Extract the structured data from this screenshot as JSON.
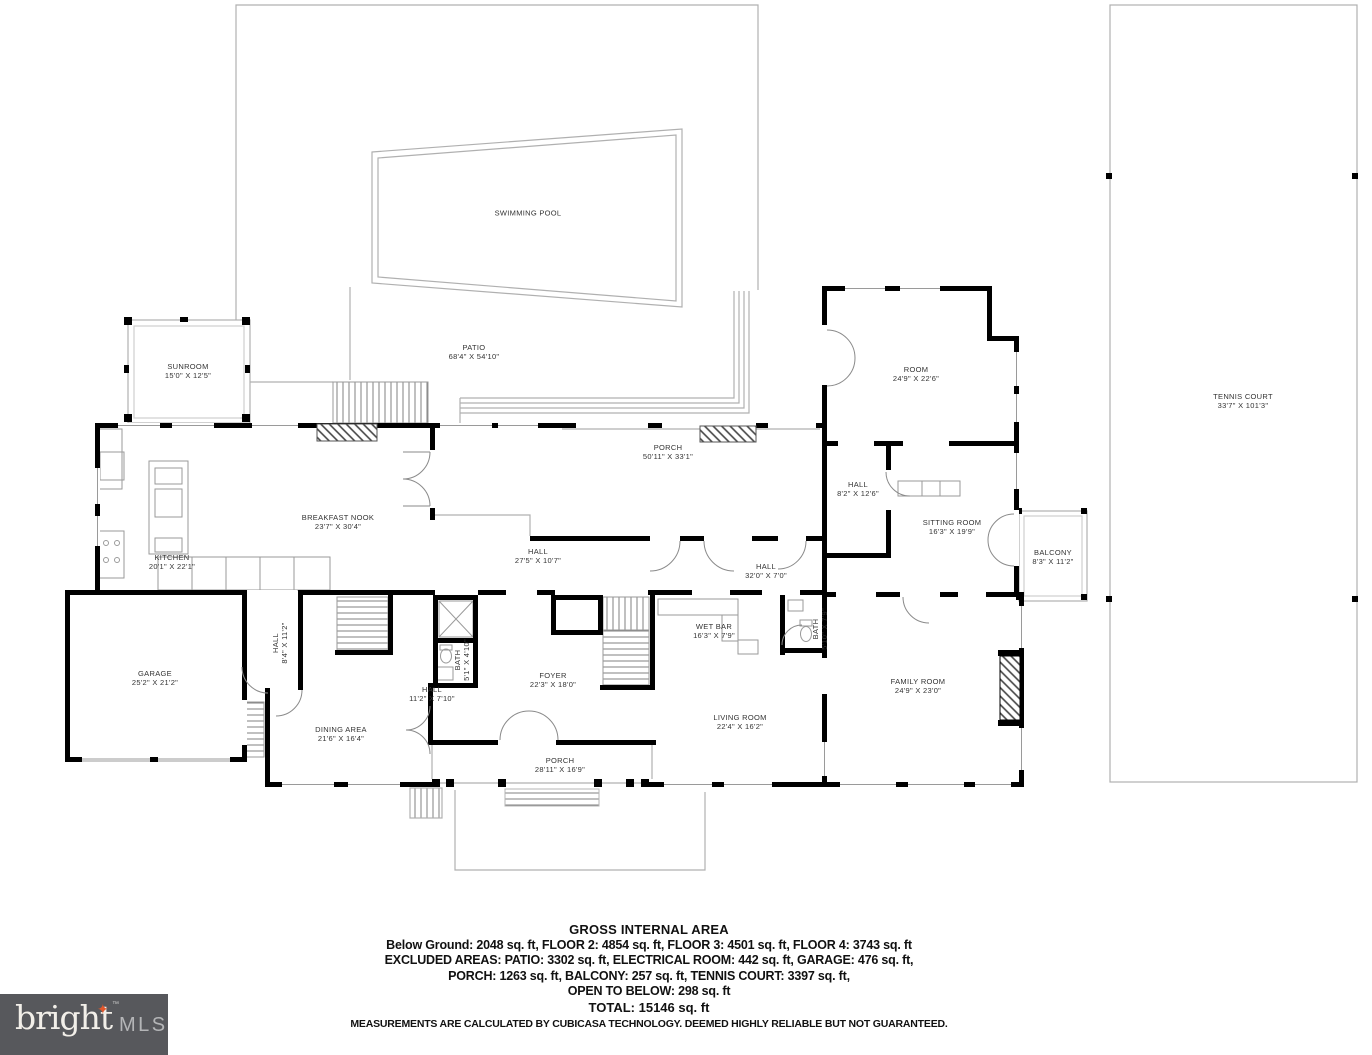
{
  "plan": {
    "rooms": [
      {
        "id": "swimming-pool",
        "name": "SWIMMING POOL",
        "dims": "",
        "x": 528,
        "y": 213
      },
      {
        "id": "patio",
        "name": "PATIO",
        "dims": "68'4\" X 54'10\"",
        "x": 474,
        "y": 352
      },
      {
        "id": "sunroom",
        "name": "SUNROOM",
        "dims": "15'0\" X 12'5\"",
        "x": 188,
        "y": 371
      },
      {
        "id": "tennis-court",
        "name": "TENNIS COURT",
        "dims": "33'7\" X 101'3\"",
        "x": 1243,
        "y": 401
      },
      {
        "id": "room",
        "name": "ROOM",
        "dims": "24'9\" X 22'6\"",
        "x": 916,
        "y": 374
      },
      {
        "id": "porch-rear",
        "name": "PORCH",
        "dims": "50'11\" X 33'1\"",
        "x": 668,
        "y": 452
      },
      {
        "id": "hall-upper",
        "name": "HALL",
        "dims": "8'2\" X 12'6\"",
        "x": 858,
        "y": 489
      },
      {
        "id": "sitting-room",
        "name": "SITTING ROOM",
        "dims": "16'3\" X 19'9\"",
        "x": 952,
        "y": 527
      },
      {
        "id": "balcony",
        "name": "BALCONY",
        "dims": "8'3\" X 11'2\"",
        "x": 1053,
        "y": 557
      },
      {
        "id": "breakfast-nook",
        "name": "BREAKFAST NOOK",
        "dims": "23'7\" X 30'4\"",
        "x": 338,
        "y": 522
      },
      {
        "id": "kitchen",
        "name": "KITCHEN",
        "dims": "20'1\" X 22'1\"",
        "x": 172,
        "y": 562
      },
      {
        "id": "hall-west",
        "name": "HALL",
        "dims": "27'5\" X 10'7\"",
        "x": 538,
        "y": 556
      },
      {
        "id": "hall-center",
        "name": "HALL",
        "dims": "32'0\" X 7'0\"",
        "x": 766,
        "y": 571
      },
      {
        "id": "garage",
        "name": "GARAGE",
        "dims": "25'2\" X 21'2\"",
        "x": 155,
        "y": 678
      },
      {
        "id": "hall-stairs",
        "name": "HALL",
        "dims": "8'4\" X 11'2\"",
        "x": 280,
        "y": 643,
        "rot": true
      },
      {
        "id": "bath-foyer",
        "name": "BATH",
        "dims": "5'1\" X 4'10\"",
        "x": 462,
        "y": 660,
        "rot": true
      },
      {
        "id": "hall-south",
        "name": "HALL",
        "dims": "11'2\" X 7'10\"",
        "x": 432,
        "y": 694
      },
      {
        "id": "dining-area",
        "name": "DINING AREA",
        "dims": "21'6\" X 16'4\"",
        "x": 341,
        "y": 734
      },
      {
        "id": "foyer",
        "name": "FOYER",
        "dims": "22'3\" X 18'0\"",
        "x": 553,
        "y": 680
      },
      {
        "id": "wet-bar",
        "name": "WET BAR",
        "dims": "16'3\" X 7'9\"",
        "x": 714,
        "y": 631
      },
      {
        "id": "bath-wetbar",
        "name": "BATH",
        "dims": "5'10\" X 7'9\"",
        "x": 820,
        "y": 629,
        "rot": true
      },
      {
        "id": "living-room",
        "name": "LIVING ROOM",
        "dims": "22'4\" X 16'2\"",
        "x": 740,
        "y": 722
      },
      {
        "id": "family-room",
        "name": "FAMILY ROOM",
        "dims": "24'9\" X 23'0\"",
        "x": 918,
        "y": 686
      },
      {
        "id": "porch-front",
        "name": "PORCH",
        "dims": "28'11\" X 16'9\"",
        "x": 560,
        "y": 765
      }
    ],
    "footer": {
      "lines": [
        "GROSS INTERNAL AREA",
        "Below Ground: 2048 sq. ft, FLOOR 2: 4854 sq. ft, FLOOR 3: 4501 sq. ft, FLOOR 4: 3743 sq. ft",
        "EXCLUDED AREAS: PATIO: 3302 sq. ft, ELECTRICAL ROOM: 442 sq. ft, GARAGE: 476 sq. ft,",
        "PORCH: 1263 sq. ft, BALCONY: 257 sq. ft, TENNIS COURT: 3397 sq. ft,",
        "OPEN TO BELOW: 298 sq. ft",
        "TOTAL: 15146 sq. ft",
        "MEASUREMENTS ARE CALCULATED BY CUBICASA TECHNOLOGY. DEEMED HIGHLY RELIABLE BUT NOT GUARANTEED."
      ]
    },
    "logo": {
      "brand": "bright",
      "tm": "™",
      "suffix": "MLS",
      "star_icon": "✦"
    },
    "colors": {
      "wall": "#000000",
      "thin_line": "#b0b0b0",
      "logo_bg": "#57585c",
      "logo_star": "#e2572b",
      "logo_text": "#f2efe9",
      "logo_suffix": "#b4b5b7"
    }
  }
}
